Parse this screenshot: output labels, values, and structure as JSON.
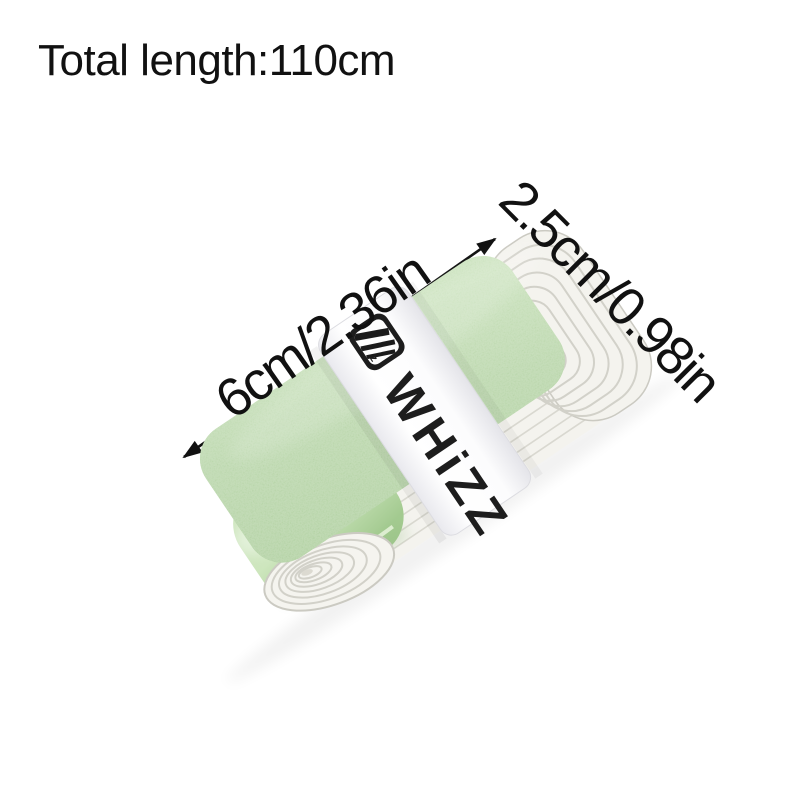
{
  "title": {
    "text": "Total length:110cm"
  },
  "dimensions": {
    "length_label": "6cm/2.36in",
    "width_label": "2.5cm/0.98in"
  },
  "product": {
    "brand": "WHiZZ",
    "logo_sub": "z"
  },
  "icons": {
    "length_arrow": "double-headed-arrow",
    "width_arrow": "double-headed-arrow",
    "logo": "whizz-monogram"
  },
  "colors": {
    "bg": "#ffffff",
    "ink": "#111111",
    "tape-green": "#aacd98",
    "tape-gloss": "#d9ecca",
    "band-white": "#fbfbfc",
    "layer-white": "#f4f3ee",
    "layer-line": "#d2d1c9",
    "brand-ink": "#1d1d1d"
  }
}
